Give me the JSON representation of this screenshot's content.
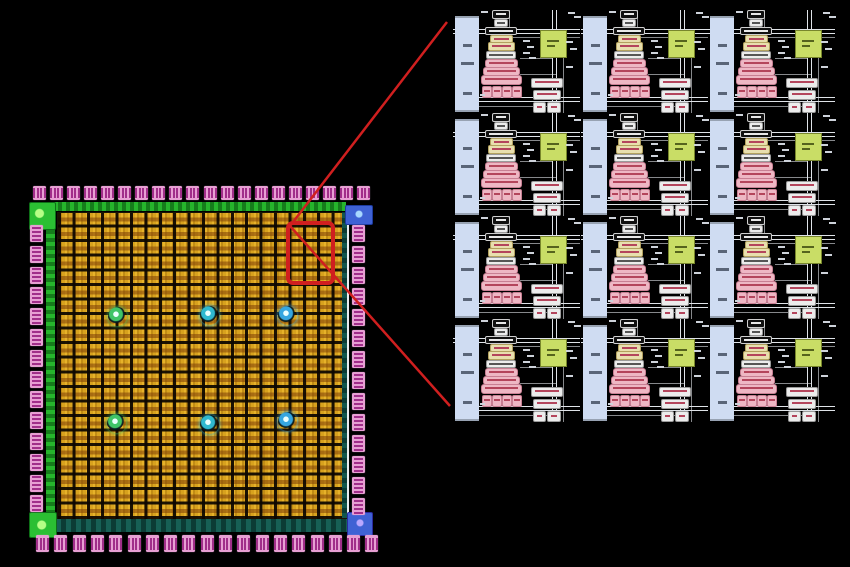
{
  "background": "#000000",
  "die": {
    "io_pads": {
      "top": 20,
      "bottom": 19,
      "left": 14,
      "right": 14
    },
    "core": {
      "columns": 20,
      "rows": 21
    },
    "spots": [
      {
        "x": 117,
        "y": 316,
        "color": "#3fc468"
      },
      {
        "x": 209,
        "y": 315,
        "color": "#2fb9cf"
      },
      {
        "x": 287,
        "y": 315,
        "color": "#36a6e0"
      },
      {
        "x": 116,
        "y": 423,
        "color": "#3fc468"
      },
      {
        "x": 209,
        "y": 424,
        "color": "#2fb9cf"
      },
      {
        "x": 287,
        "y": 421,
        "color": "#36a6e0"
      }
    ],
    "colors": {
      "core_gold": "#c8941a",
      "pad_pink": "#e79fd3",
      "pad_glyph": "#a12e8a",
      "ring_green": "#26b52c",
      "ring_teal": "#176055",
      "corner_green": "#2bbf33",
      "corner_blue": "#3f62d4"
    }
  },
  "callout": {
    "color": "#d01f1f",
    "rect": {
      "x": 288,
      "y": 223,
      "width": 45,
      "height": 60
    },
    "lines": [
      {
        "x1": 290,
        "y1": 226,
        "x2": 447,
        "y2": 22
      },
      {
        "x1": 290,
        "y1": 226,
        "x2": 450,
        "y2": 406
      }
    ]
  },
  "zoom_panel": {
    "rows": 4,
    "columns": 3,
    "cell_colors": {
      "ram_bar": "#cfdcf2",
      "config_green": "#c9dd66",
      "block_pink": "#eeb7c4",
      "block_yellow": "#e8dfae",
      "block_white": "#ececec",
      "block_dark": "#101010",
      "bus_line": "#dfe3e8"
    }
  }
}
